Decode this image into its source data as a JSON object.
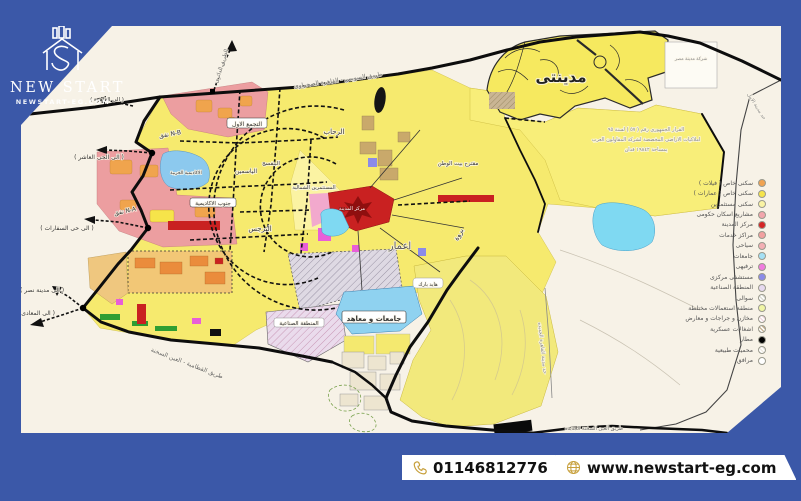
{
  "brand": {
    "name": "NEW START",
    "site": "NEWSTART-EG.COM"
  },
  "footer": {
    "phone": "01146812776",
    "website": "www.newstart-eg.com"
  },
  "colors": {
    "frame_blue": "#3B58A8",
    "gold": "#C7A03C",
    "map_cream": "#F7F2E7",
    "city_yellow": "#F6EA6E",
    "red_center": "#C92121"
  },
  "map": {
    "labels": {
      "madinaty": "مدينتى",
      "rehab": "الرحاب",
      "tagamoa": "التجمع الاول",
      "yasmeen": "الياسمين",
      "banafseg": "البنفسج",
      "mostathmereen": "المستثمرين الشمالية",
      "south_academy": "جنوب الاكاديمية",
      "narges": "النرجس",
      "city_center": "مركز المدينة",
      "emaar": "اعمار",
      "barwa": "بروة",
      "beit_watan": "مقترح بيت الوطن",
      "academy": "الاكاديمية الحربية",
      "hyde_park": "هايد بارك",
      "universities": "جامعات و معاهد",
      "industrial": "المنطقة الصناعية",
      "madinet_misr": "شركة مدينة مصر",
      "suez_road": "طريق السويس - القاهرة الصحراوى",
      "ring_road": "الطريق الدائرى",
      "to_cairo": "( الى القاهرة )",
      "tunnel_nb": "نفق N-B",
      "to_tenth": "( الى الحى العاشر )",
      "tunnel_na": "نفق N-A",
      "to_embassies": "( الى حى السفارات )",
      "to_nasr": "( الى مدينة نصر )",
      "to_maadi": "( الى المعادى )",
      "katameya_road": "طريق القطامية - العين السخنة",
      "sokhna_road": "طريق العين السخنة الجديده",
      "amal_border": "حد مدينة الامل",
      "nc_border": "حد مدينة القاهرة الجديده",
      "decree1": "القرار الجمهورى رقم ( ٥٧ ) لسنة ٩٥",
      "decree2": "املاكيات الاراضى المخصصة لشركة المقاولون العرب",
      "decree3": "بمساحة ١٩٨٤٢ فدان"
    },
    "legend": {
      "items": [
        {
          "label": "سكنى خاص ( فيلات )",
          "color": "#F0A352",
          "style": "solid"
        },
        {
          "label": "سكنى خاص ( عمارات )",
          "color": "#F6E44A",
          "style": "solid"
        },
        {
          "label": "سكنى مستثمرين",
          "color": "#FAF3A3",
          "style": "solid"
        },
        {
          "label": "مشاريع اسكان حكومى",
          "color": "#F2A6AC",
          "style": "solid"
        },
        {
          "label": "مركز المدينة",
          "color": "#D42525",
          "style": "solid"
        },
        {
          "label": "مراكز خدمات",
          "color": "#F2A0A0",
          "style": "solid"
        },
        {
          "label": "سياحى",
          "color": "#F3AFB4",
          "style": "solid"
        },
        {
          "label": "جامعات",
          "color": "#A5E0F4",
          "style": "solid"
        },
        {
          "label": "ترفيهى",
          "color": "#F07BDE",
          "style": "solid"
        },
        {
          "label": "مستشفى مركزى",
          "color": "#8B8BE8",
          "style": "solid"
        },
        {
          "label": "المنطقة الصناعية",
          "color": "#E6D9EF",
          "style": "solid"
        },
        {
          "label": "سوالى",
          "color": "#DDDDD3",
          "style": "hatch"
        },
        {
          "label": "منطقة استعمالات مختلطة",
          "color": "#F0F5A5",
          "style": "solid"
        },
        {
          "label": "مخازن و جراجات و معارض",
          "color": "#F4DBE2",
          "style": "hatch"
        },
        {
          "label": "اشغالات عسكرية",
          "color": "#C9B594",
          "style": "hatch"
        },
        {
          "label": "مطار",
          "color": "#000000",
          "style": "solid"
        },
        {
          "label": "محميات طبيعية",
          "color": "#EFEBE2",
          "style": "hatch"
        },
        {
          "label": "مرافق",
          "color": "#FFFFFF",
          "style": "outline"
        }
      ]
    }
  }
}
